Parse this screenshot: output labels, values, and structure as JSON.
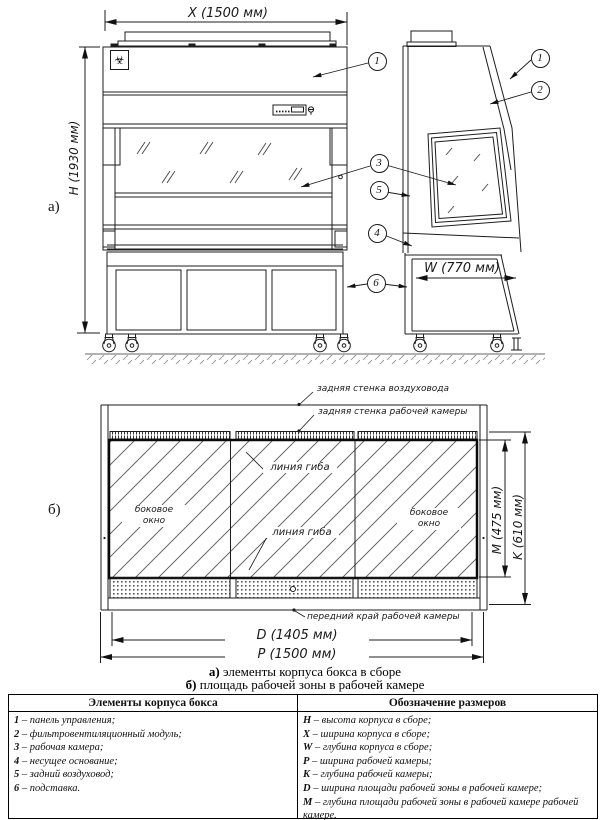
{
  "drawing": {
    "dim_x": "X (1500 мм)",
    "dim_h": "H (1930 мм)",
    "dim_w": "W (770 мм)",
    "dim_m": "M (475 мм)",
    "dim_k": "K (610 мм)",
    "dim_d": "D (1405 мм)",
    "dim_p": "P (1500 мм)",
    "view_a": "а)",
    "view_b": "б)",
    "callouts": [
      "1",
      "2",
      "3",
      "4",
      "5",
      "6"
    ],
    "biohazard_symbol": "☣"
  },
  "labels": {
    "duct_back_wall": "задняя стенка воздуховода",
    "chamber_back_wall": "задняя стенка рабочей камеры",
    "fold_line": "линия гиба",
    "side_window_line1": "боковое",
    "side_window_line2": "окно",
    "front_edge": "передний край рабочей камеры"
  },
  "captions": {
    "a_prefix": "а)",
    "a_text": " элементы корпуса бокса в сборе",
    "b_prefix": "б)",
    "b_text": " площадь рабочей зоны в рабочей камере"
  },
  "table": {
    "col1_header": "Элементы корпуса бокса",
    "col2_header": "Обозначение размеров",
    "elements": [
      {
        "num": "1",
        "desc": "– панель управления;"
      },
      {
        "num": "2",
        "desc": "– фильтровентиляционный модуль;"
      },
      {
        "num": "3",
        "desc": "– рабочая камера;"
      },
      {
        "num": "4",
        "desc": "– несущее основание;"
      },
      {
        "num": "5",
        "desc": "– задний воздуховод;"
      },
      {
        "num": "6",
        "desc": "– подставка."
      }
    ],
    "sizes": [
      {
        "key": "H",
        "desc": "– высота корпуса в сборе;"
      },
      {
        "key": "X",
        "desc": "– ширина корпуса в сборе;"
      },
      {
        "key": "W",
        "desc": "– глубина корпуса в сборе;"
      },
      {
        "key": "P",
        "desc": "– ширина рабочей камеры;"
      },
      {
        "key": "K",
        "desc": "– глубина рабочей камеры;"
      },
      {
        "key": "D",
        "desc": "– ширина площади рабочей зоны в рабочей камере;"
      },
      {
        "key": "M",
        "desc": "– глубина площади рабочей зоны в рабочей камере рабочей камере."
      }
    ]
  }
}
